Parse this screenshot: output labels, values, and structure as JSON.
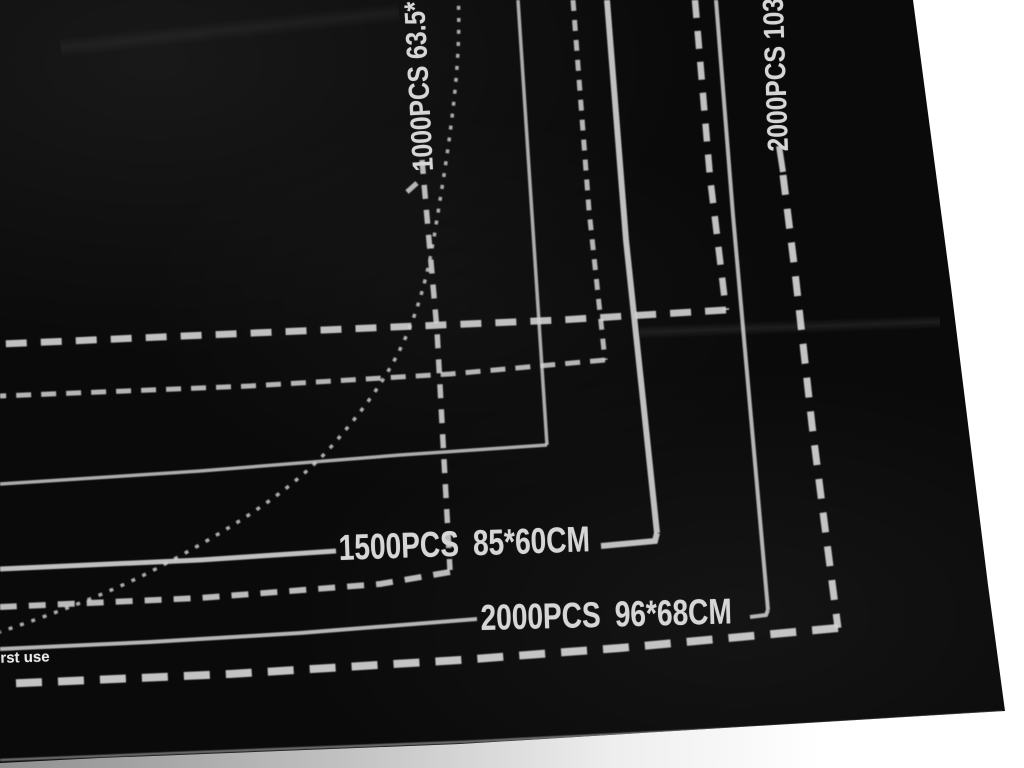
{
  "scene": {
    "description": "black felt jigsaw puzzle roll-up mat photographed at an angle on a white background, printed with concentric size guide rectangles"
  },
  "colors": {
    "mat": "#0a0a0a",
    "print": "#d4d4d4",
    "background": "#ffffff",
    "shadow_strip": "#8f8f8f"
  },
  "labels": {
    "mat_1000_top": "1000PCS 63.5*",
    "mat_2000_top": "2000PCS 103",
    "mat_1500_pcs": "1500PCS",
    "mat_1500_dim": "85*60CM",
    "mat_2000_pcs": "2000PCS",
    "mat_2000_dim": "96*68CM",
    "first_use": "first use"
  }
}
